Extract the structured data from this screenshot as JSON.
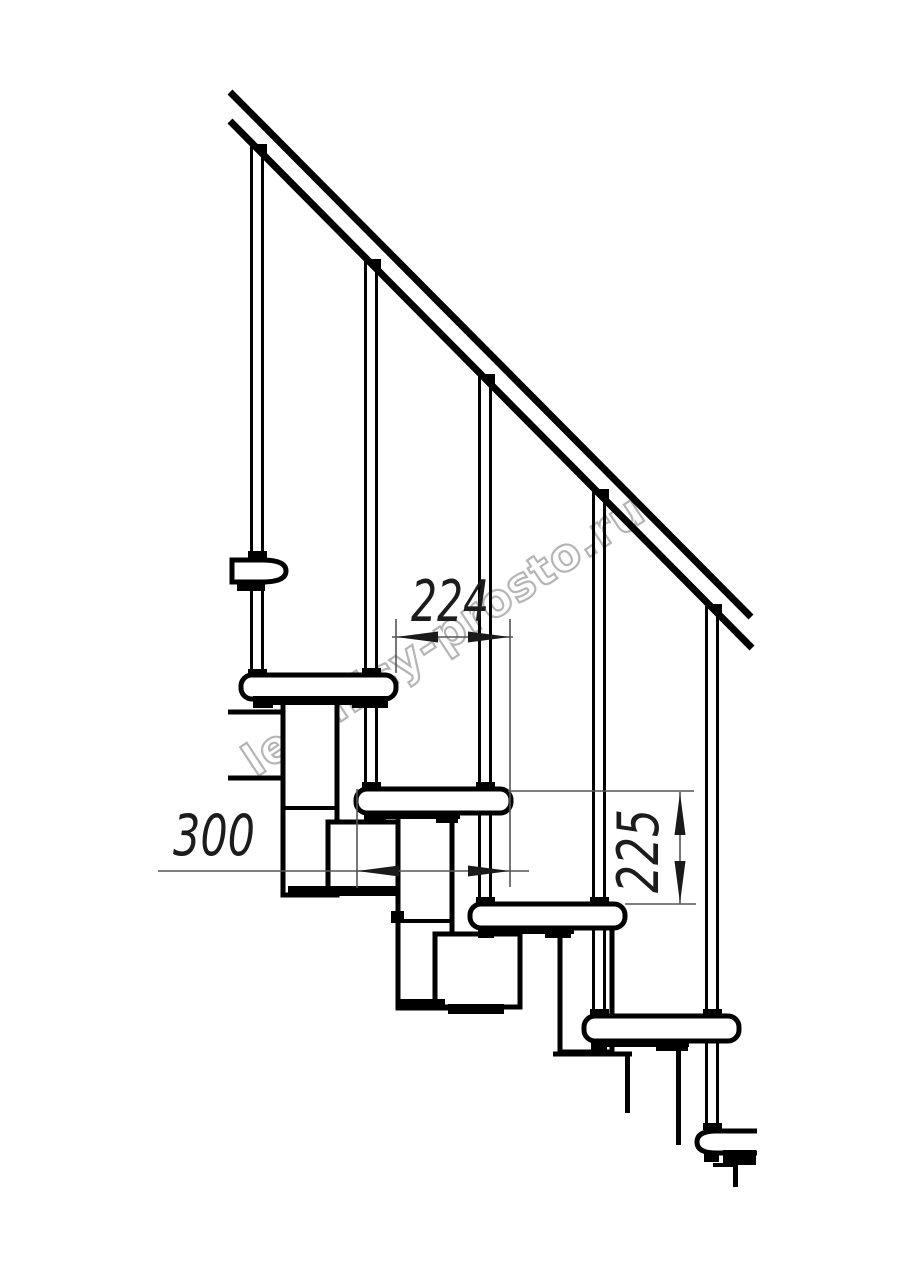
{
  "watermark": {
    "text": "lestnicy-prosto.ru"
  },
  "dimensions": {
    "step_run": {
      "value": "224"
    },
    "step_length": {
      "value": "300"
    },
    "step_rise": {
      "value": "225"
    }
  }
}
